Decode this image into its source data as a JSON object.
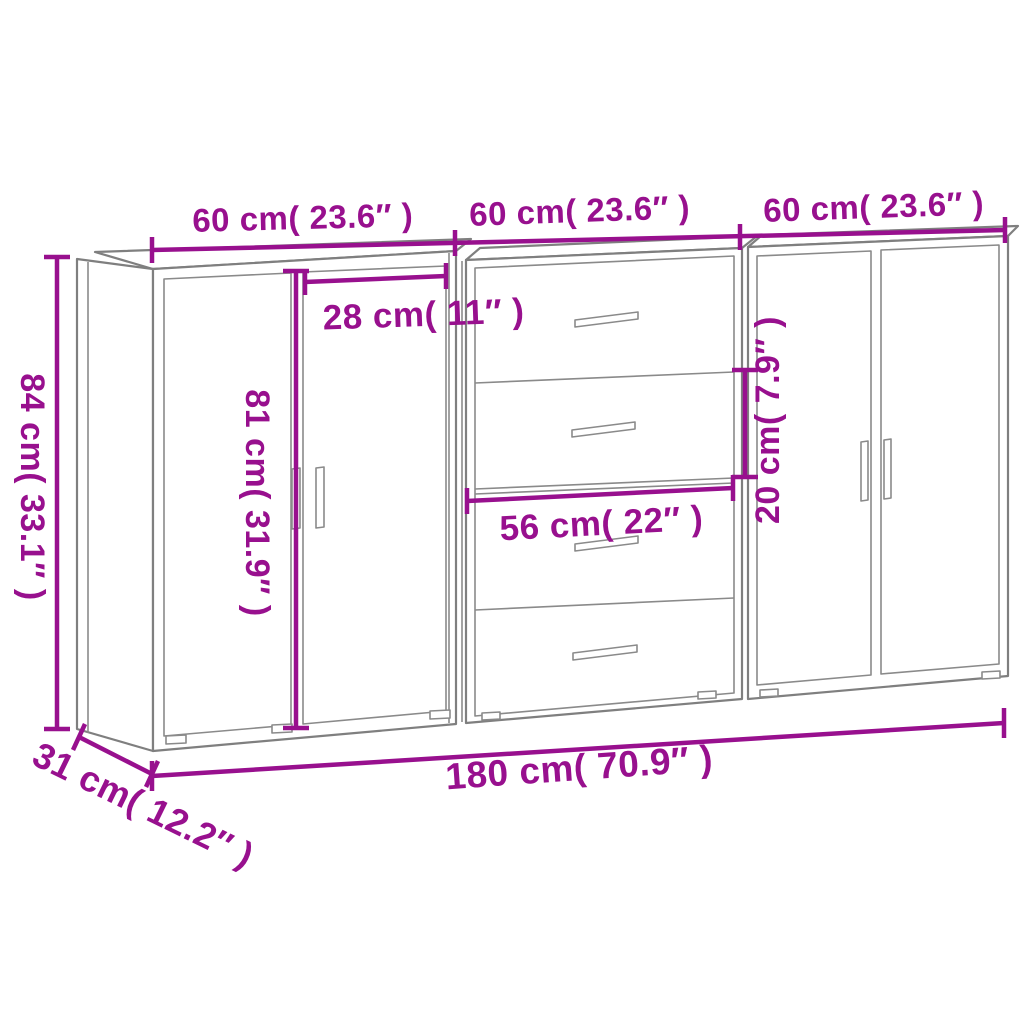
{
  "diagram": {
    "title": "Three sideboards dimension diagram",
    "background_color": "#ffffff",
    "outline_color": "#7f7f7f",
    "dimension_color": "#98108e",
    "cabinets": [
      {
        "position": "left",
        "type": "2-door cabinet"
      },
      {
        "position": "middle",
        "type": "4-drawer cabinet"
      },
      {
        "position": "right",
        "type": "2-door cabinet"
      }
    ],
    "labels": {
      "unit1_width": "60 cm( 23.6″ )",
      "unit2_width": "60 cm( 23.6″ )",
      "unit3_width": "60 cm( 23.6″ )",
      "overall_height": "84 cm( 33.1″ )",
      "door_height": "81 cm( 31.9″ )",
      "door_width": "28 cm( 11″ )",
      "drawer_width": "56 cm( 22″ )",
      "drawer_height": "20 cm( 7.9″ )",
      "overall_width": "180 cm( 70.9″ )",
      "overall_depth": "31 cm( 12.2″ )"
    },
    "measurements": [
      {
        "name": "unit width",
        "cm": 60,
        "inches": 23.6,
        "count": 3
      },
      {
        "name": "overall height",
        "cm": 84,
        "inches": 33.1
      },
      {
        "name": "door height",
        "cm": 81,
        "inches": 31.9
      },
      {
        "name": "door width",
        "cm": 28,
        "inches": 11
      },
      {
        "name": "drawer width",
        "cm": 56,
        "inches": 22
      },
      {
        "name": "drawer height",
        "cm": 20,
        "inches": 7.9
      },
      {
        "name": "overall width",
        "cm": 180,
        "inches": 70.9
      },
      {
        "name": "overall depth",
        "cm": 31,
        "inches": 12.2
      }
    ]
  }
}
